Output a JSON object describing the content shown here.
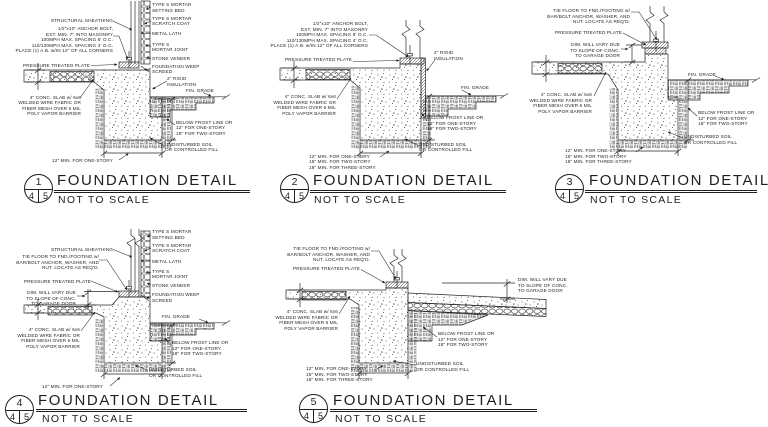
{
  "page": {
    "background": "#ffffff",
    "ink": "#1f1f1f"
  },
  "details": [
    {
      "number": "1",
      "sheet_left": "4",
      "sheet_right": "5",
      "title": "FOUNDATION DETAIL",
      "scale": "NOT TO SCALE",
      "labels": {
        "setting_bed": "TYPE S MORTAR\nSETTING BED",
        "scratch_coat": "TYPE S MORTAR\nSCRATCH COAT",
        "sheathing": "STRUCTURAL SHEATHING",
        "anchor_bolt": "1/2\"x10\" ANCHOR BOLT,\nEXT. MIN. 7\" INTO MASONRY\n100MPH MAX. SPACING 6' O.C.\n110/130MPH MAX. SPACING 4' O.C.\nPLACE (1) A.B. w/IN 12\" OF ALL CORNERS",
        "metal_lath": "METAL LATH",
        "mortar_joint": "TYPE S\nMORTAR JOINT",
        "stone_veneer": "STONE VENEER",
        "weep_screed": "FOUNDATION WEEP\nSCREED",
        "pressure_plate": "PRESSURE TREATED PLATE",
        "rigid_insulation": "2\" RIGID\nINSULATION",
        "fin_grade": "FIN. GRADE",
        "slab": "4\" CONC. SLAB w/ 6x6\nWELDED WIRE FABRIC OR\nFIBER MESH OVER 6 MIL\nPOLY VAPOR BARRIER",
        "frost": "BELOW FROST LINE OR\n12\" FOR ONE-STORY\n18\" FOR TWO-STORY",
        "soil": "UNDISTURBED SOIL\nOR CONTROLLED FILL",
        "width": "12\" MIN. FOR ONE-STORY"
      }
    },
    {
      "number": "2",
      "sheet_left": "4",
      "sheet_right": "5",
      "title": "FOUNDATION DETAIL",
      "scale": "NOT TO SCALE",
      "labels": {
        "anchor_bolt": "1/2\"x10\" ANCHOR BOLT,\nEXT. MIN. 7\" INTO MASONRY\n100MPH MAX. SPACING 6' O.C.\n110/130MPH MAX. SPACING 4' O.C.\nPLACE (1) A.B. w/IN 12\" OF ALL CORNERS",
        "pressure_plate": "PRESSURE TREATED PLATE",
        "rigid_insulation": "2\" RIGID\nINSULATION",
        "fin_grade": "FIN. GRADE",
        "slab": "4\" CONC. SLAB w/ 6x6\nWELDED WIRE FABRIC OR\nFIBER MESH OVER 6 MIL\nPOLY VAPOR BARRIER",
        "frost": "BELOW FROST LINE OR\n12\" FOR ONE-STORY\n18\" FOR TWO-STORY",
        "soil": "UNDISTURBED SOIL\nOR CONTROLLED FILL",
        "width": "12\" MIN. FOR ONE-STORY\n15\" MIN. FOR TWO-STORY\n18\" MIN. FOR THREE-STORY"
      }
    },
    {
      "number": "3",
      "sheet_left": "4",
      "sheet_right": "5",
      "title": "FOUNDATION DETAIL",
      "scale": "NOT TO SCALE",
      "labels": {
        "tie_floor": "TIE FLOOR TO FND./FOOTING w/\nBAR/BOLT ANCHOR, WASHER, AND\nNUT. LOCATE AS REQ'D.",
        "pressure_plate": "PRESSURE TREATED PLATE",
        "dim_vary": "DIM. WILL VARY DUE\nTO SLOPE OF CONC.\nTO GARAGE DOOR",
        "fin_grade": "FIN. GRADE",
        "slab": "4\" CONC. SLAB w/ 6x6\nWELDED WIRE FABRIC OR\nFIBER MESH OVER 6 MIL\nPOLY VAPOR BARRIER",
        "frost": "BELOW FROST LINE OR\n12\" FOR ONE-STORY\n18\" FOR TWO-STORY",
        "soil": "UNDISTURBED SOIL\nOR CONTROLLED FILL",
        "width": "12\" MIN. FOR ONE-STORY\n15\" MIN. FOR TWO-STORY\n18\" MIN. FOR THREE-STORY"
      }
    },
    {
      "number": "4",
      "sheet_left": "4",
      "sheet_right": "5",
      "title": "FOUNDATION DETAIL",
      "scale": "NOT TO SCALE",
      "labels": {
        "setting_bed": "TYPE S MORTAR\nSETTING BED",
        "scratch_coat": "TYPE S MORTAR\nSCRATCH COAT",
        "sheathing": "STRUCTURAL SHEATHING",
        "tie_floor": "TIE FLOOR TO FND./FOOTING w/\nBAR/BOLT ANCHOR, WASHER, AND\nNUT. LOCATE AS REQ'D.",
        "metal_lath": "METAL LATH",
        "mortar_joint": "TYPE S\nMORTAR JOINT",
        "pressure_plate": "PRESSURE TREATED PLATE",
        "stone_veneer": "STONE VENEER",
        "dim_vary": "DIM. WILL VARY DUE\nTO SLOPE OF CONC.\nTO GARAGE DOOR",
        "weep_screed": "FOUNDATION WEEP\nSCREED",
        "fin_grade": "FIN. GRADE",
        "slab": "4\" CONC. SLAB w/ 6x6\nWELDED WIRE FABRIC OR\nFIBER MESH OVER 6 MIL\nPOLY VAPOR BARRIER",
        "frost": "BELOW FROST LINE OR\n12\" FOR ONE-STORY\n18\" FOR TWO-STORY",
        "soil": "UNDISTURBED SOIL\nOR CONTROLLED FILL",
        "width": "12\" MIN. FOR ONE-STORY"
      }
    },
    {
      "number": "5",
      "sheet_left": "4",
      "sheet_right": "5",
      "title": "FOUNDATION DETAIL",
      "scale": "NOT TO SCALE",
      "labels": {
        "tie_floor": "TIE FLOOR TO FND./FOOTING w/\nBAR/BOLT ANCHOR, WASHER, AND\nNUT. LOCATE AS REQ'D.",
        "pressure_plate": "PRESSURE TREATED PLATE",
        "dim_vary": "DIM. WILL VARY DUE\nTO SLOPE OF CONC.\nTO GARAGE DOOR",
        "slab": "4\" CONC. SLAB w/ 6x6\nWELDED WIRE FABRIC OR\nFIBER MESH OVER 6 MIL\nPOLY VAPOR BARRIER",
        "frost": "BELOW FROST LINE OR\n12\" FOR ONE-STORY\n18\" FOR TWO-STORY",
        "soil": "UNDISTURBED SOIL\nOR CONTROLLED FILL",
        "width": "12\" MIN. FOR ONE-STORY\n15\" MIN. FOR TWO-STORY\n18\" MIN. FOR THREE-STORY"
      }
    }
  ]
}
